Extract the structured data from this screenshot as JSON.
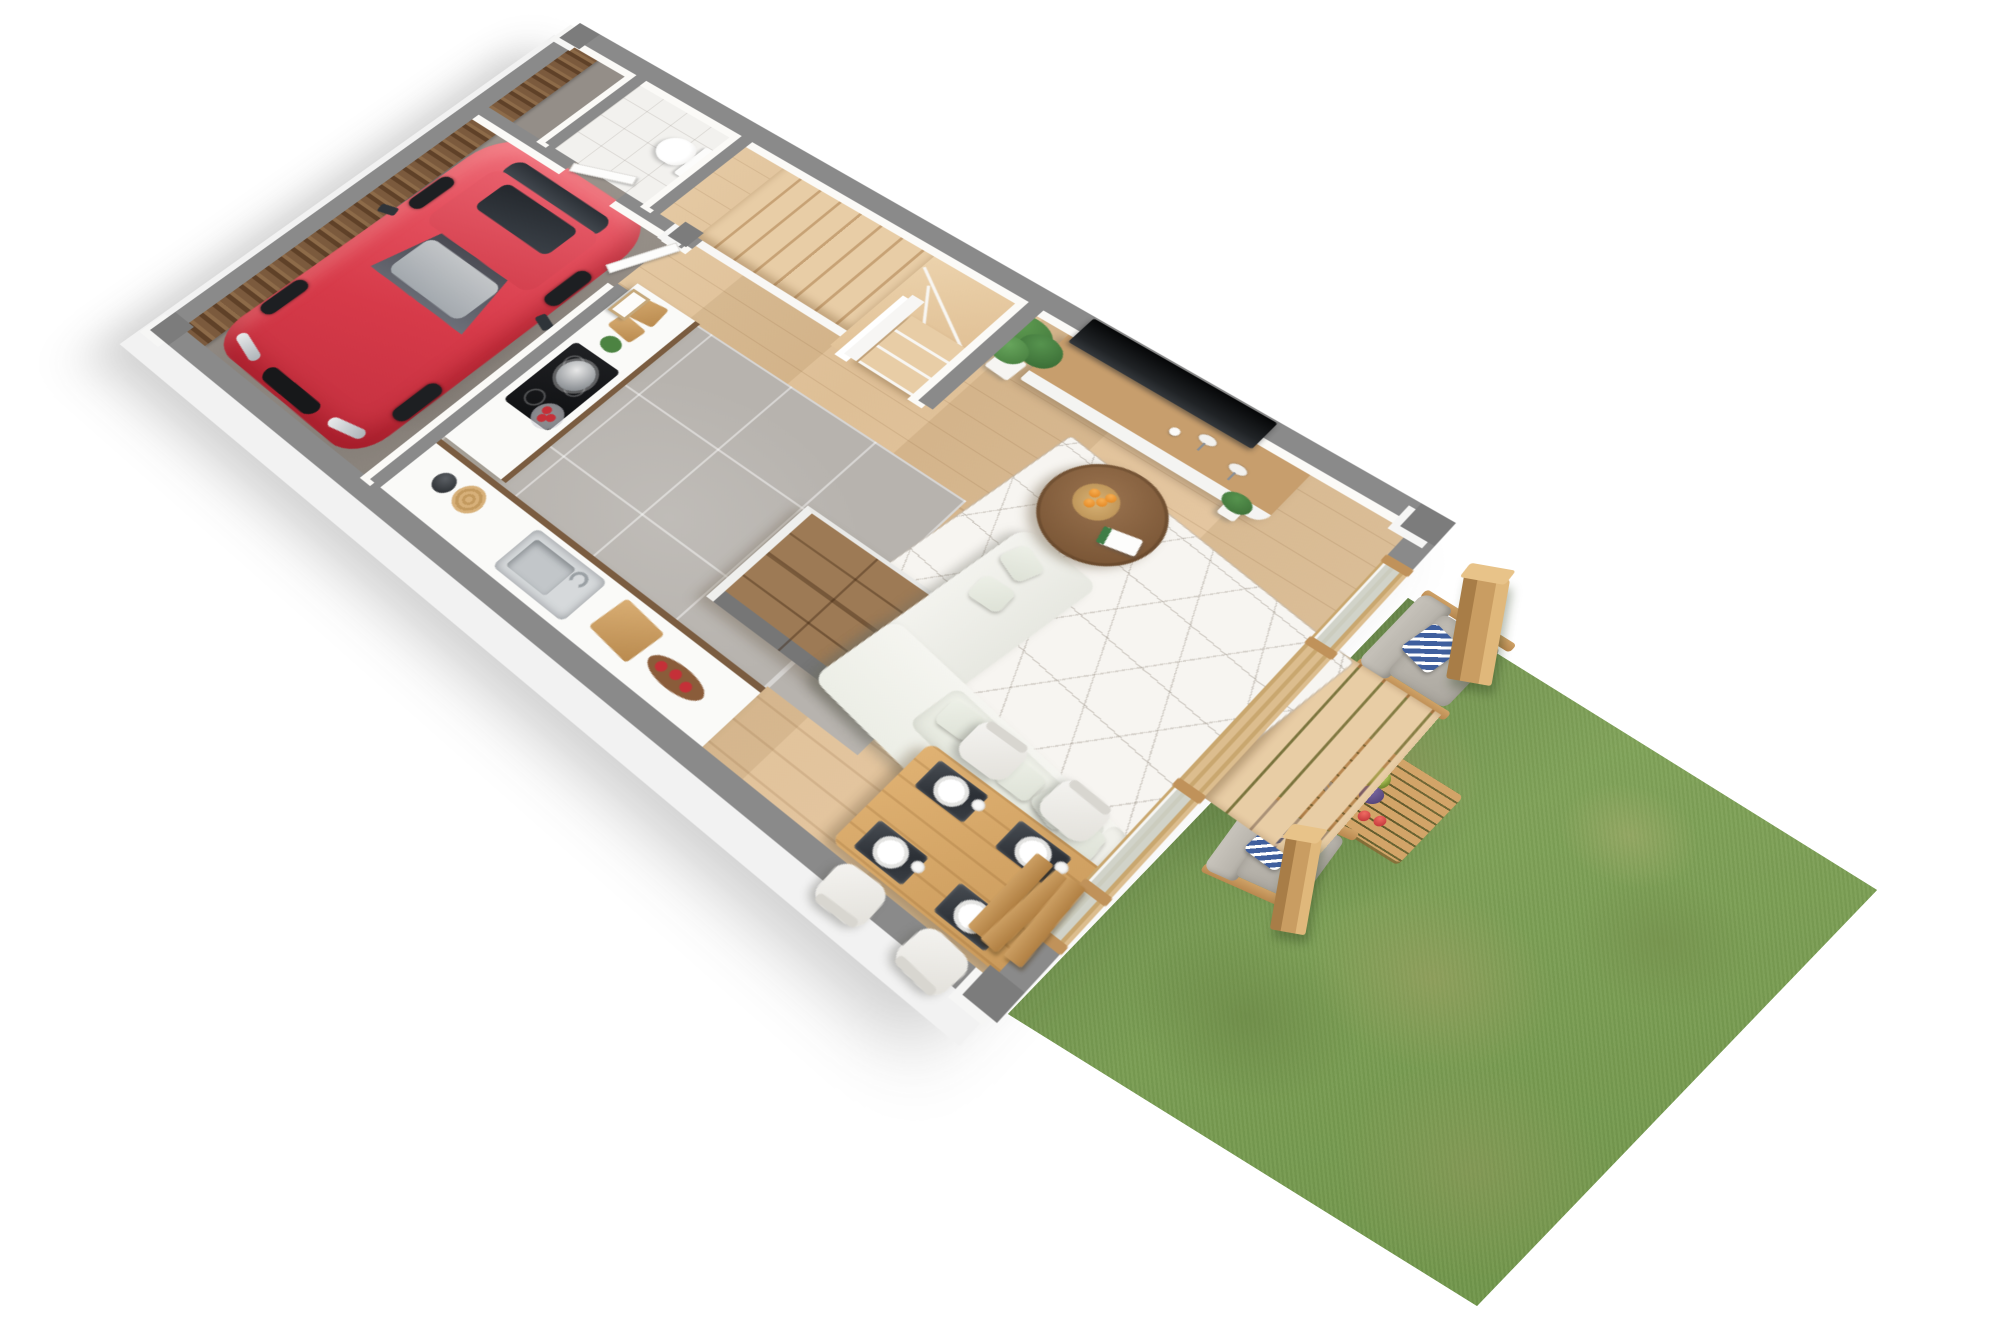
{
  "scene": {
    "title": "3D cutaway floor plan render — ground floor of a terraced house with garage, open-plan kitchen/living/dining, winder staircase, WC and back garden lawn",
    "view": "top-down perspective dollhouse cutaway, plan rotated about 32 degrees",
    "background_color": "#ffffff"
  },
  "palette": {
    "wall_cap_gray": "#8a8a8a",
    "wall_face_white": "#f7f6f4",
    "oak_floor": "#e0c098",
    "garage_concrete": "#96908a",
    "garage_wood_cladding": "#7b5a3d",
    "kitchen_tile_gray": "#b7b3ae",
    "car_red": "#d63a49",
    "walnut_cabinets": "#7a5c40",
    "island_walnut": "#9d7a55",
    "dining_oak": "#d4a362",
    "sofa_white": "#f0f0ea",
    "rug_white": "#f7f5f1",
    "tv_black": "#111315",
    "grass_green": "#7ea157",
    "outdoor_wood": "#c99d62",
    "chevron_pillow_blue": "#3f5f9e"
  },
  "rooms": {
    "garage": {
      "label": "Garage",
      "floor": "concrete with tire marks",
      "contents": [
        "red hatchback car",
        "dark wood clad wall",
        "interior door to hallway"
      ]
    },
    "bathroom": {
      "label": "WC",
      "floor": "white tile",
      "contents": [
        "toilet with cistern",
        "white panelled door"
      ]
    },
    "hallway": {
      "label": "Hallway with winder staircase",
      "floor": "oak planks",
      "contents": [
        "L-shaped wooden winder stairs",
        "white guard walls",
        "framed picture"
      ]
    },
    "kitchen": {
      "label": "Kitchen",
      "floor": "large grey tiles",
      "contents": [
        "L-shaped white counter with walnut fronts",
        "black induction hob with steel pot",
        "glass bowl of apples",
        "stainless sink with tap",
        "cutting boards",
        "kettle",
        "apple tray",
        "walnut kitchen island with grey end panel"
      ]
    },
    "living_room": {
      "label": "Living room",
      "floor": "oak planks",
      "contents": [
        "white corner sofa with scatter cushions",
        "white geometric triangle-pattern rug",
        "round walnut coffee table with plate of oranges and a green book",
        "wall-mounted black TV",
        "wood-top media sideboard with two small lamps and vase",
        "tall potted ficus plant",
        "small potted plant"
      ]
    },
    "dining_area": {
      "label": "Dining area",
      "floor": "oak planks",
      "contents": [
        "oak dining table",
        "4 white chairs",
        "4 dark marble placemats",
        "white plates and cups",
        "folded bi-fold door stack"
      ]
    }
  },
  "garden": {
    "label": "Back garden lawn",
    "surface": "green lawn with worn yellowish patches",
    "contents": [
      "grey cushioned wooden armchair with blue-white chevron pillow (upper)",
      "grey cushioned wooden armchair with blue-white chevron pillow (lower)",
      "slatted wooden coffee table with grapes, orange juice and apples",
      "tall wooden post planter (upper)",
      "wooden post planter (lower)",
      "building shadow on grass"
    ]
  },
  "exterior": {
    "glass_wall": "full-height sliding glazing with wooden frames facing the garden, one open section",
    "deck": "small wooden deck strip outside the living room opening",
    "walls": "white exterior faces with grey cut-plane caps"
  },
  "vehicle": {
    "label": "Red hatchback parked in garage",
    "color": "#d63a49",
    "details": [
      "dark sunroof",
      "grey interior seats",
      "roof antenna",
      "black grille",
      "LED headlights"
    ]
  }
}
